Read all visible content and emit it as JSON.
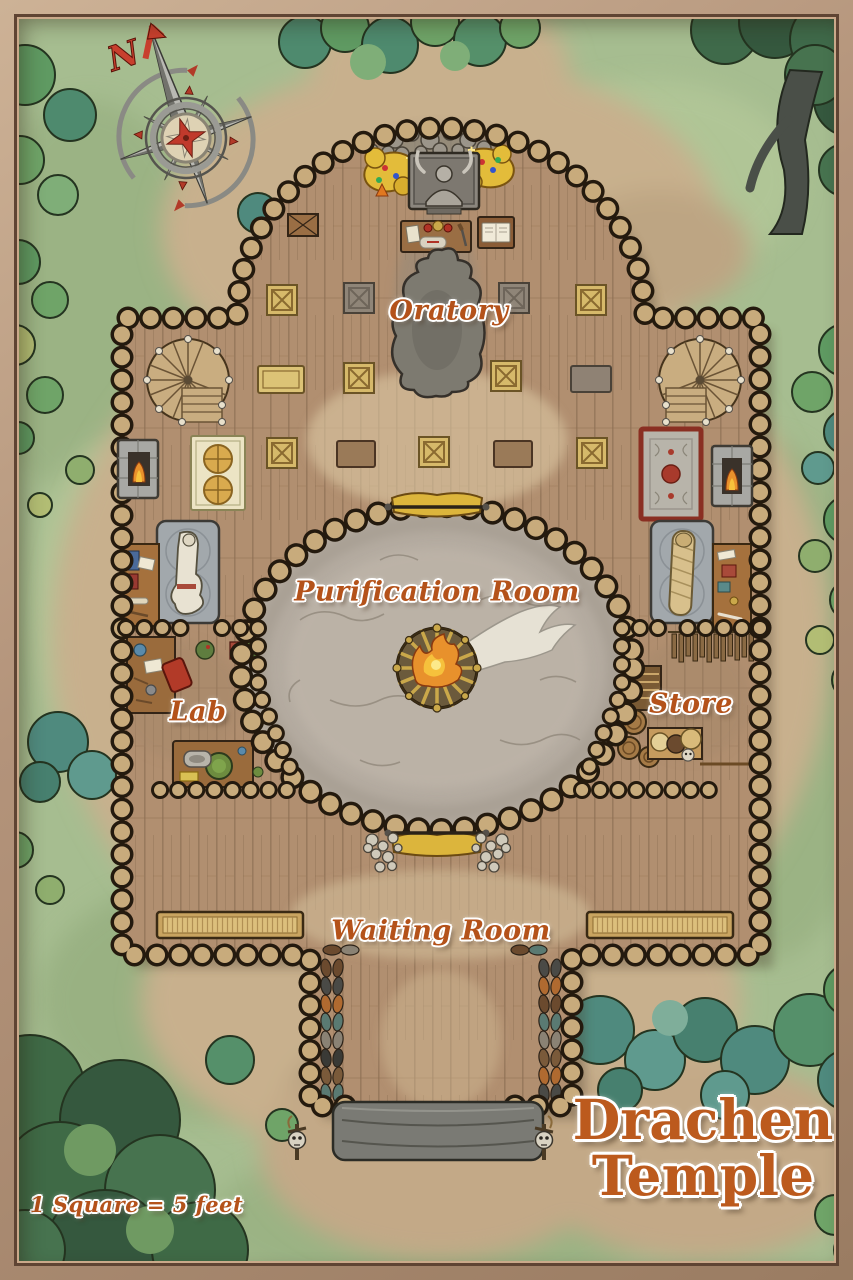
{
  "map": {
    "title": "Drachen Temple",
    "title_line1": "Drachen",
    "title_line2": "Temple",
    "scale_note": "1 Square = 5 feet",
    "compass_north": "N",
    "rooms": {
      "oratory": "Oratory",
      "purification": "Purification Room",
      "lab": "Lab",
      "store": "Store",
      "waiting": "Waiting Room"
    },
    "features": [
      "compass-rose",
      "central-fire-brazier",
      "demon-altar",
      "treasure-piles",
      "rubble-rocks",
      "ritual-table",
      "lectern-with-book",
      "prayer-mats",
      "hooded-statue",
      "spiral-staircase-left",
      "spiral-staircase-right",
      "fireplace-left",
      "fireplace-right",
      "prayer-rug",
      "red-rug",
      "corpse-slab",
      "mummy-slab",
      "scribe-desk",
      "side-table",
      "alchemy-desk",
      "red-chair",
      "herb-shelf",
      "work-bench",
      "hanging-racks",
      "shelf-stack",
      "barrels",
      "sack-table",
      "waiting-bench-left",
      "waiting-bench-right",
      "shoe-rows",
      "golden-curtains",
      "skull-piles",
      "entrance-steps",
      "skull-totems",
      "trees",
      "bushes"
    ],
    "colors": {
      "label_text": "#b4521a",
      "title_text": "#bc5a1d",
      "grass": "#a6bd90",
      "dirt": "#c8b08d",
      "wood_floor": "#b18f70",
      "wall_log": "#c8ab7c",
      "wall_outline": "#241a0e",
      "smoke_floor": "#b4aba0",
      "frame_wood": "#b3937a",
      "gold_curtain": "#dcb53c",
      "fire": "#f0a02c",
      "compass_red": "#c8402e"
    }
  }
}
